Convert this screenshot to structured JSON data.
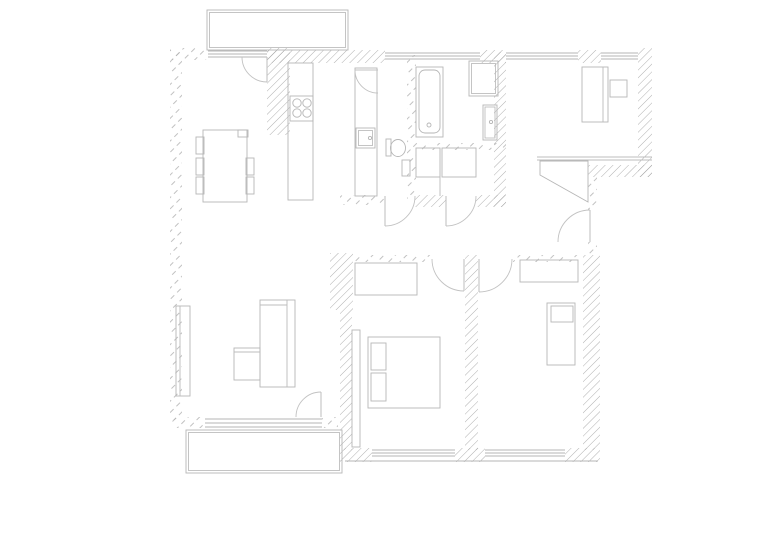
{
  "canvas": {
    "width": 778,
    "height": 550,
    "background": "#ffffff"
  },
  "palette": {
    "hatch_dense": "#9c9c9c",
    "hatch_sparse": "#b2b2b2",
    "fixture_stroke": "#b6b6b6",
    "door_stroke": "#c2c2c2",
    "window_stroke": "#b6b6b6",
    "line_stroke": "#bcbcbc"
  },
  "floor_plan": {
    "walls": [
      {
        "x": 267,
        "y": 48,
        "w": 23,
        "h": 87,
        "style": "dense",
        "name": "wall-kitchen-column"
      },
      {
        "x": 267,
        "y": 50,
        "w": 118,
        "h": 13,
        "style": "dense",
        "name": "wall-top-1"
      },
      {
        "x": 480,
        "y": 50,
        "w": 26,
        "h": 13,
        "style": "dense",
        "name": "wall-top-2"
      },
      {
        "x": 578,
        "y": 50,
        "w": 23,
        "h": 13,
        "style": "dense",
        "name": "wall-top-pier"
      },
      {
        "x": 638,
        "y": 48,
        "w": 14,
        "h": 129,
        "style": "dense",
        "name": "wall-right"
      },
      {
        "x": 588,
        "y": 165,
        "w": 64,
        "h": 12,
        "style": "dense",
        "name": "wall-entry-top"
      },
      {
        "x": 494,
        "y": 52,
        "w": 12,
        "h": 155,
        "style": "dense",
        "name": "wall-bath-right"
      },
      {
        "x": 415,
        "y": 195,
        "w": 31,
        "h": 12,
        "style": "dense",
        "name": "wall-bath-bottom-1"
      },
      {
        "x": 476,
        "y": 195,
        "w": 30,
        "h": 12,
        "style": "dense",
        "name": "wall-bath-bottom-2"
      },
      {
        "x": 330,
        "y": 253,
        "w": 23,
        "h": 57,
        "style": "dense",
        "name": "wall-bedroom1-corner"
      },
      {
        "x": 340,
        "y": 310,
        "w": 12,
        "h": 140,
        "style": "dense",
        "name": "wall-bedroom1-left"
      },
      {
        "x": 465,
        "y": 255,
        "w": 13,
        "h": 195,
        "style": "dense",
        "name": "wall-between-bedrooms"
      },
      {
        "x": 583,
        "y": 255,
        "w": 17,
        "h": 195,
        "style": "dense",
        "name": "wall-bedroom2-right"
      },
      {
        "x": 340,
        "y": 448,
        "w": 32,
        "h": 14,
        "style": "dense",
        "name": "wall-bottom-pier-1"
      },
      {
        "x": 455,
        "y": 448,
        "w": 30,
        "h": 14,
        "style": "dense",
        "name": "wall-bottom-pier-2"
      },
      {
        "x": 565,
        "y": 448,
        "w": 35,
        "h": 14,
        "style": "dense",
        "name": "wall-bottom-pier-3"
      },
      {
        "x": 170,
        "y": 48,
        "w": 12,
        "h": 372,
        "style": "sparse",
        "name": "wall-left"
      },
      {
        "x": 170,
        "y": 48,
        "w": 38,
        "h": 12,
        "style": "sparse",
        "name": "wall-top-left"
      },
      {
        "x": 407,
        "y": 55,
        "w": 9,
        "h": 145,
        "style": "sparse",
        "name": "wall-wc-right"
      },
      {
        "x": 416,
        "y": 143,
        "w": 90,
        "h": 7,
        "style": "sparse",
        "name": "wall-bath-partition"
      },
      {
        "x": 340,
        "y": 195,
        "w": 45,
        "h": 10,
        "style": "sparse",
        "name": "wall-wc-bottom"
      },
      {
        "x": 352,
        "y": 255,
        "w": 81,
        "h": 7,
        "style": "sparse",
        "name": "wall-bedroom1-top"
      },
      {
        "x": 513,
        "y": 255,
        "w": 70,
        "h": 7,
        "style": "sparse",
        "name": "wall-bedroom2-top"
      },
      {
        "x": 588,
        "y": 177,
        "w": 9,
        "h": 33,
        "style": "sparse",
        "name": "wall-entry-side-upper"
      },
      {
        "x": 588,
        "y": 242,
        "w": 9,
        "h": 13,
        "style": "sparse",
        "name": "wall-entry-side-lower"
      },
      {
        "x": 170,
        "y": 417,
        "w": 35,
        "h": 11,
        "style": "sparse",
        "name": "wall-living-bottom-left"
      },
      {
        "x": 322,
        "y": 417,
        "w": 16,
        "h": 11,
        "style": "sparse",
        "name": "wall-living-bottom-right"
      }
    ],
    "windows": [
      {
        "x1": 208,
        "x2": 267,
        "ys": [
          51,
          54,
          57
        ],
        "name": "window-balcony-door-threshold"
      },
      {
        "x1": 385,
        "x2": 480,
        "ys": [
          53,
          56,
          59
        ],
        "name": "window-bathroom"
      },
      {
        "x1": 506,
        "x2": 578,
        "ys": [
          53,
          56,
          59
        ],
        "name": "window-office-1"
      },
      {
        "x1": 601,
        "x2": 638,
        "ys": [
          53,
          56,
          59
        ],
        "name": "window-office-2"
      },
      {
        "x1": 205,
        "x2": 322,
        "ys": [
          419,
          423,
          427
        ],
        "name": "window-living"
      },
      {
        "x1": 372,
        "x2": 455,
        "ys": [
          450,
          453,
          456
        ],
        "name": "window-bedroom1"
      },
      {
        "x1": 485,
        "x2": 565,
        "ys": [
          450,
          453,
          456
        ],
        "name": "window-bedroom2"
      },
      {
        "x1": 345,
        "x2": 598,
        "ys": [
          461
        ],
        "name": "window-sill-line"
      }
    ],
    "doors": [
      {
        "leaf": [
          267,
          57,
          267,
          82
        ],
        "arc": {
          "from": [
            242,
            57
          ],
          "to": [
            267,
            82
          ],
          "r": 25,
          "sweep": 0
        },
        "name": "door-kitchen-balcony"
      },
      {
        "leaf": [
          355,
          70,
          378,
          70
        ],
        "arc": {
          "from": [
            355,
            70
          ],
          "to": [
            378,
            93
          ],
          "r": 23,
          "sweep": 0
        },
        "name": "door-wc"
      },
      {
        "leaf": [
          385,
          196,
          385,
          226
        ],
        "arc": {
          "from": [
            385,
            226
          ],
          "to": [
            415,
            196
          ],
          "r": 30,
          "sweep": 0
        },
        "name": "door-bathroom-1"
      },
      {
        "leaf": [
          446,
          196,
          446,
          226
        ],
        "arc": {
          "from": [
            446,
            226
          ],
          "to": [
            476,
            196
          ],
          "r": 30,
          "sweep": 0
        },
        "name": "door-bathroom-2"
      },
      {
        "leaf": [
          590,
          210,
          590,
          242
        ],
        "arc": {
          "from": [
            590,
            210
          ],
          "to": [
            558,
            242
          ],
          "r": 32,
          "sweep": 0
        },
        "name": "door-entry"
      },
      {
        "leaf": [
          321,
          392,
          321,
          417
        ],
        "arc": {
          "from": [
            296,
            417
          ],
          "to": [
            321,
            392
          ],
          "r": 25,
          "sweep": 1
        },
        "name": "door-living-terrace"
      },
      {
        "leaf": [
          464,
          259,
          464,
          291
        ],
        "arc": {
          "from": [
            432,
            259
          ],
          "to": [
            464,
            291
          ],
          "r": 32,
          "sweep": 0
        },
        "name": "door-bedroom1"
      },
      {
        "leaf": [
          479,
          259,
          479,
          292
        ],
        "arc": {
          "from": [
            479,
            292
          ],
          "to": [
            512,
            259
          ],
          "r": 33,
          "sweep": 0
        },
        "name": "door-bedroom2"
      }
    ],
    "rects": [
      {
        "x": 207,
        "y": 10,
        "w": 141,
        "h": 40,
        "inset": 2.5,
        "name": "balcony"
      },
      {
        "x": 186,
        "y": 430,
        "w": 156,
        "h": 43,
        "inset": 2.5,
        "name": "terrace"
      },
      {
        "x": 288,
        "y": 63,
        "w": 25,
        "h": 137,
        "name": "kitchen-counter-1"
      },
      {
        "x": 290,
        "y": 96,
        "w": 23,
        "h": 25,
        "name": "stove"
      },
      {
        "x": 355,
        "y": 68,
        "w": 22,
        "h": 128,
        "name": "kitchen-counter-2"
      },
      {
        "x": 356,
        "y": 128,
        "w": 19,
        "h": 20,
        "inset": 2.5,
        "name": "kitchen-sink"
      },
      {
        "x": 386,
        "y": 139,
        "w": 5,
        "h": 17,
        "name": "toilet-cistern"
      },
      {
        "x": 402,
        "y": 160,
        "w": 8,
        "h": 16,
        "name": "wall-cabinet"
      },
      {
        "x": 416,
        "y": 67,
        "w": 27,
        "h": 70,
        "name": "bathtub"
      },
      {
        "x": 419,
        "y": 70,
        "w": 21,
        "h": 63,
        "rx": 6,
        "name": "bathtub-inner"
      },
      {
        "x": 469,
        "y": 61,
        "w": 29,
        "h": 35,
        "inset": 2.5,
        "name": "washing-machine"
      },
      {
        "x": 483,
        "y": 105,
        "w": 14,
        "h": 35,
        "inset": 2,
        "name": "washbasin"
      },
      {
        "x": 416,
        "y": 148,
        "w": 24,
        "h": 29,
        "name": "shower-tray"
      },
      {
        "x": 442,
        "y": 148,
        "w": 34,
        "h": 29,
        "name": "bathroom-vanity"
      },
      {
        "x": 582,
        "y": 67,
        "w": 26,
        "h": 55,
        "name": "desk"
      },
      {
        "x": 610,
        "y": 80,
        "w": 17,
        "h": 17,
        "name": "desk-chair"
      },
      {
        "x": 355,
        "y": 263,
        "w": 62,
        "h": 32,
        "name": "wardrobe-bedroom1"
      },
      {
        "x": 352,
        "y": 330,
        "w": 8,
        "h": 117,
        "name": "shelf-bedroom1"
      },
      {
        "x": 368,
        "y": 337,
        "w": 72,
        "h": 71,
        "name": "bed-double"
      },
      {
        "x": 371,
        "y": 343,
        "w": 15,
        "h": 27,
        "name": "pillow-1"
      },
      {
        "x": 371,
        "y": 373,
        "w": 15,
        "h": 28,
        "name": "pillow-2"
      },
      {
        "x": 520,
        "y": 260,
        "w": 58,
        "h": 22,
        "name": "wardrobe-bedroom2"
      },
      {
        "x": 547,
        "y": 303,
        "w": 28,
        "h": 62,
        "name": "bed-single"
      },
      {
        "x": 551,
        "y": 306,
        "w": 22,
        "h": 16,
        "name": "pillow-3"
      },
      {
        "x": 176,
        "y": 306,
        "w": 14,
        "h": 90,
        "name": "sideboard"
      },
      {
        "x": 260,
        "y": 300,
        "w": 35,
        "h": 87,
        "name": "sofa-main"
      },
      {
        "x": 234,
        "y": 348,
        "w": 26,
        "h": 32,
        "name": "sofa-chaise"
      },
      {
        "x": 203,
        "y": 130,
        "w": 44,
        "h": 72,
        "name": "dining-table"
      },
      {
        "x": 196,
        "y": 137,
        "w": 8,
        "h": 17,
        "name": "chair-left-1"
      },
      {
        "x": 196,
        "y": 158,
        "w": 8,
        "h": 17,
        "name": "chair-left-2"
      },
      {
        "x": 196,
        "y": 177,
        "w": 8,
        "h": 17,
        "name": "chair-left-3"
      },
      {
        "x": 246,
        "y": 158,
        "w": 8,
        "h": 17,
        "name": "chair-right-1"
      },
      {
        "x": 246,
        "y": 177,
        "w": 8,
        "h": 17,
        "name": "chair-right-2"
      },
      {
        "x": 238,
        "y": 130,
        "w": 10,
        "h": 7,
        "name": "chair-head"
      }
    ],
    "circles": [
      {
        "cx": 297,
        "cy": 103,
        "r": 4.2,
        "name": "burner-1"
      },
      {
        "cx": 307,
        "cy": 103,
        "r": 4.2,
        "name": "burner-2"
      },
      {
        "cx": 297,
        "cy": 113,
        "r": 4.2,
        "name": "burner-3"
      },
      {
        "cx": 307,
        "cy": 113,
        "r": 4.2,
        "name": "burner-4"
      },
      {
        "cx": 398,
        "cy": 148,
        "r": 7.5,
        "ry": 8.5,
        "name": "toilet-bowl"
      },
      {
        "cx": 370,
        "cy": 138,
        "r": 1.6,
        "name": "sink-faucet"
      },
      {
        "cx": 429,
        "cy": 125,
        "r": 2,
        "name": "bathtub-drain"
      },
      {
        "cx": 491,
        "cy": 122,
        "r": 1.6,
        "name": "washbasin-faucet"
      }
    ],
    "lines": [
      {
        "p": [
          537,
          157,
          652,
          157
        ],
        "name": "entry-wall-line-1"
      },
      {
        "p": [
          537,
          160,
          652,
          160
        ],
        "name": "entry-wall-line-2"
      },
      {
        "p": [
          440,
          148,
          440,
          196
        ],
        "name": "bathroom-divider"
      },
      {
        "p": [
          603,
          67,
          603,
          122
        ],
        "name": "desk-edge"
      },
      {
        "p": [
          180,
          306,
          180,
          396
        ],
        "name": "sideboard-edge"
      },
      {
        "p": [
          287,
          300,
          287,
          387
        ],
        "name": "sofa-backrest"
      },
      {
        "p": [
          260,
          305,
          287,
          305
        ],
        "name": "sofa-armrest"
      },
      {
        "p": [
          234,
          352,
          260,
          352
        ],
        "name": "sofa-chaise-edge"
      }
    ],
    "polygons": [
      {
        "pts": [
          [
            540,
            161
          ],
          [
            588,
            161
          ],
          [
            588,
            202
          ],
          [
            540,
            175
          ]
        ],
        "name": "entry-wardrobe"
      }
    ]
  }
}
